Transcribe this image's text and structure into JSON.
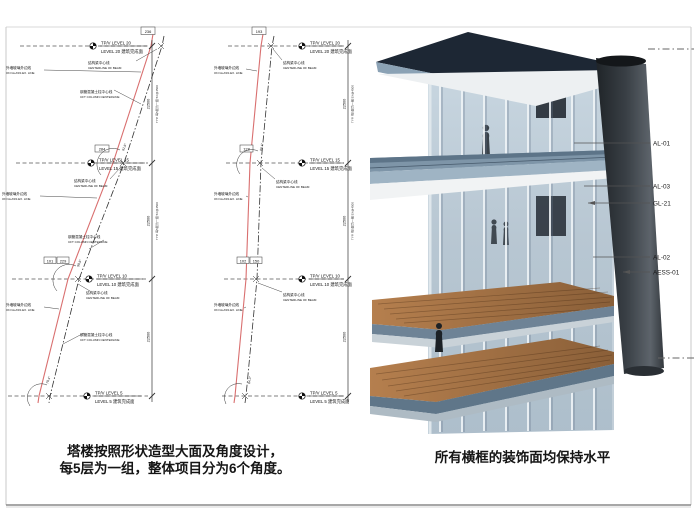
{
  "captions": {
    "left_line1": "塔楼按照形状造型大面及角度设计，",
    "left_line2": "每5层为一组，整体项目分为6个角度。",
    "right": "所有横框的装饰面均保持水平"
  },
  "dwg": {
    "levels": [
      {
        "a": "TP/V LEVEL 20",
        "b": "LEVEL 20 建筑完成面"
      },
      {
        "a": "TP/V LEVEL 15",
        "b": "LEVEL 15 建筑完成面"
      },
      {
        "a": "TP/V LEVEL 10",
        "b": "LEVEL 10 建筑完成面"
      },
      {
        "a": "TP/V LEVEL 5",
        "b": "LEVEL 5 建筑完成面"
      }
    ],
    "glass_cn": "外墙玻璃外边线",
    "glass_en": "ON GLASS EX. LINE",
    "beam_cn": "结构梁中心线",
    "beam_en": "CENTERLINE OF BEAM",
    "col_cn": "钢管混凝土柱中心线",
    "col_en": "CFT COLUMN CENTERLINE",
    "span": "22500",
    "note": "TYP. 每5层为一组 5X@4500",
    "d1": "236",
    "d2": "284",
    "d3": "101",
    "d4": "229",
    "m1": "193",
    "m2": "128",
    "m3": "102",
    "m4": "150",
    "a1": "81.6°",
    "a2": "98.6°",
    "a3": "79.4°",
    "a4": "88.4°",
    "a5": "84.3°"
  },
  "render": {
    "callouts": [
      {
        "label": "AL-01"
      },
      {
        "label": "AL-03"
      },
      {
        "label": "GL-21"
      },
      {
        "label": "AL-02"
      },
      {
        "label": "AESS-01"
      }
    ]
  },
  "colors": {
    "glass_edge_red": "#d96f6f",
    "centerline": "#333333",
    "steel_blue": "#7e95a8",
    "wood_deck": "#9a6f42",
    "column_gray": "#3a4046"
  }
}
